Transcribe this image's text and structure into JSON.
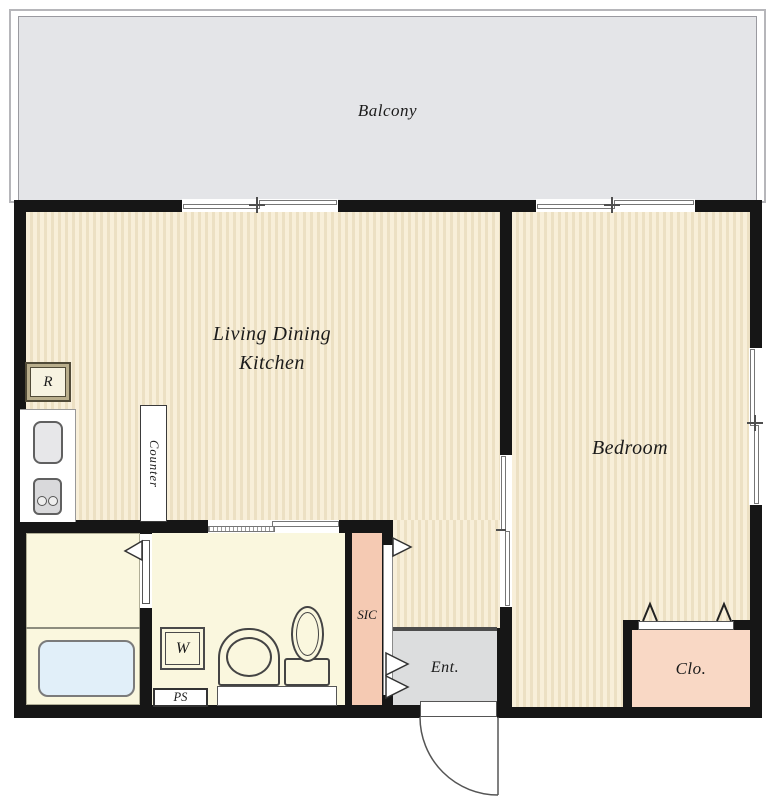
{
  "plan": {
    "balcony": {
      "label": "Balcony"
    },
    "living_dining_kitchen": {
      "label_line1": "Living Dining",
      "label_line2": "Kitchen"
    },
    "bedroom": {
      "label": "Bedroom"
    },
    "entrance": {
      "label": "Ent."
    },
    "closet": {
      "label": "Clo."
    },
    "shoe_closet": {
      "label": "SIC"
    },
    "pipe_space": {
      "label": "PS"
    },
    "kitchen": {
      "counter_label": "Counter",
      "refrigerator_label": "R"
    },
    "sanitary": {
      "washing_machine_label": "W"
    }
  },
  "colors": {
    "wall": "#161616",
    "floor_a": "#f8efd9",
    "floor_b": "#ece0c3",
    "balcony": "#e4e5e8",
    "room_cream": "#faf7de",
    "ent_gray": "#dcddde",
    "sic_salmon": "#f5cab3",
    "clo_salmon": "#f9d8c5",
    "bathtub_blue": "#e1eff9"
  }
}
